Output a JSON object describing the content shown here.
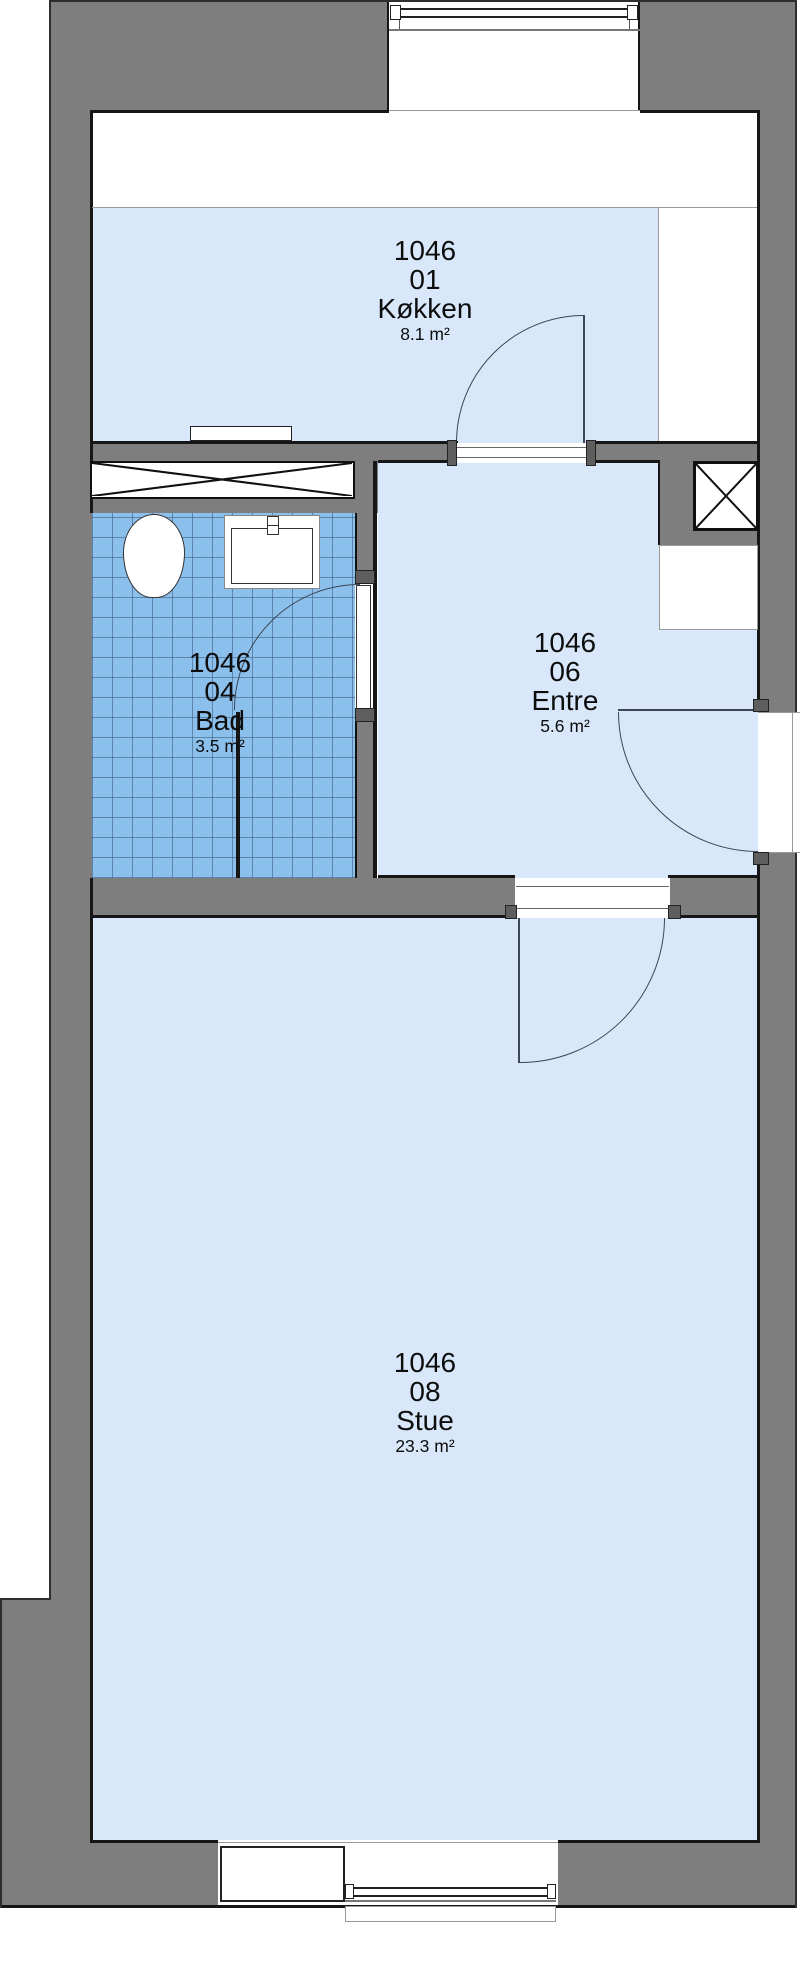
{
  "plan": {
    "rooms": [
      {
        "id": "1046",
        "number": "01",
        "name": "Køkken",
        "area": "8.1 m²"
      },
      {
        "id": "1046",
        "number": "04",
        "name": "Bad",
        "area": "3.5 m²"
      },
      {
        "id": "1046",
        "number": "06",
        "name": "Entre",
        "area": "5.6 m²"
      },
      {
        "id": "1046",
        "number": "08",
        "name": "Stue",
        "area": "23.3 m²"
      }
    ],
    "colors": {
      "wall": "#7e7e7e",
      "room_fill": "#d8e8fa",
      "tile_fill": "#8cc0ec",
      "tile_grid": "#5a7ba0",
      "line": "#161616"
    }
  }
}
